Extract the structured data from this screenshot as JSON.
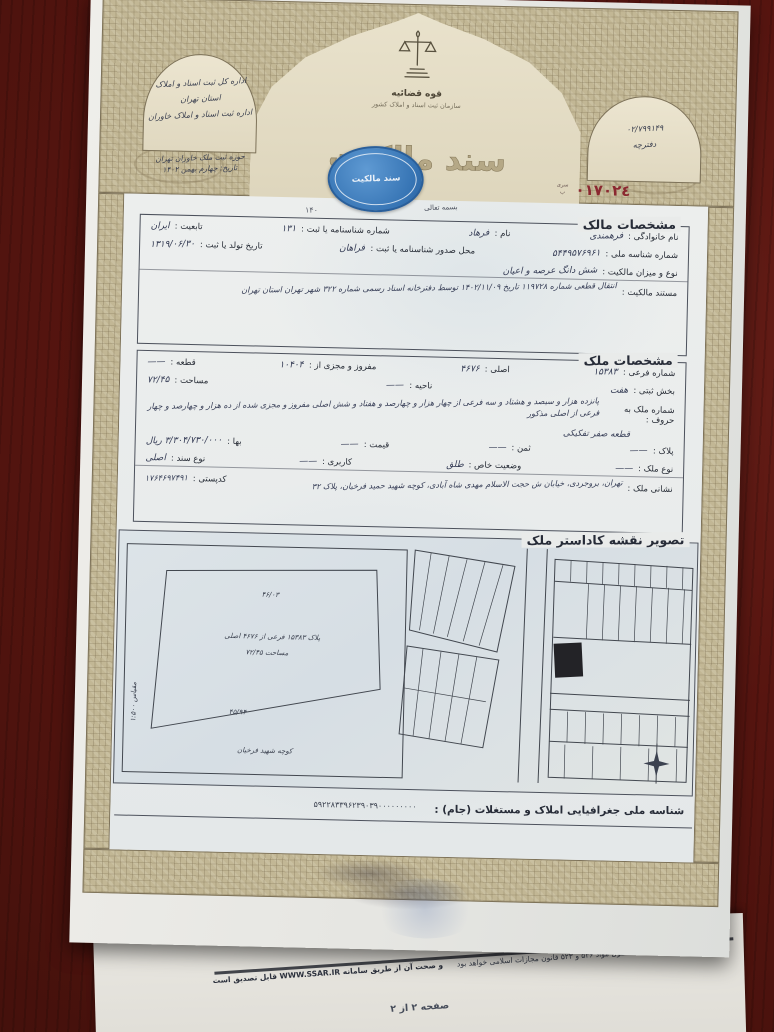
{
  "colors": {
    "seal_blue": "#3674b4",
    "serial_red": "#8b2830",
    "border_tan": "#c2b795",
    "desk_maroon": "#571510"
  },
  "document": {
    "serial": "٠١٧٠٢٤",
    "serial_caption": "سری ب",
    "bismillah": "بسمه تعالی",
    "corner_note": "۱۴۰"
  },
  "header": {
    "judiciary": "قوه قضائیه",
    "org": "سازمان ثبت اسناد و املاک کشور",
    "deed_title": "سند مالکیت",
    "seal_text": "سند مالکیت",
    "left_arch": {
      "line1": "اداره کل ثبت اسناد و املاک",
      "line2": "استان تهران",
      "line3": "اداره ثبت اسناد و املاک خاوران",
      "line4": "حوزه ثبت ملک خاوران تهران",
      "line5": "تاریخ: چهارم بهمن ۱۴۰۲"
    },
    "right_arch": {
      "number": "۰۲/۷۹۹۱۴۹",
      "caption": "دفترچه"
    }
  },
  "owner": {
    "title": "مشخصات مالک",
    "row1": [
      {
        "label": "نام خانوادگی :",
        "value": "فرهمندی"
      },
      {
        "label": "نام :",
        "value": "فرهاد"
      },
      {
        "label": "شماره شناسنامه یا ثبت :",
        "value": "۱۳۱"
      },
      {
        "label": "تابعیت :",
        "value": "ایران"
      }
    ],
    "row2": [
      {
        "label": "شماره شناسه ملی :",
        "value": "۵۴۴۹۵۷۶۹۶۱"
      },
      {
        "label": "محل صدور شناسنامه یا ثبت :",
        "value": "فراهان"
      },
      {
        "label": "تاریخ تولد یا ثبت :",
        "value": "۱۳۱۹/۰۶/۳۰"
      }
    ],
    "row3": {
      "label": "نوع و میزان مالکیت :",
      "value": "شش دانگ عرصه و اعیان"
    },
    "row4": {
      "label": "مستند مالکیت :",
      "value": "انتقال قطعی شماره ۱۱۹۷۲۸ تاریخ ۱۴۰۲/۱۱/۰۹ توسط دفترخانه اسناد رسمی شماره ۳۲۲ شهر تهران استان تهران"
    }
  },
  "property": {
    "title": "مشخصات ملک",
    "row1": [
      {
        "label": "شماره فرعی :",
        "value": "۱۵۳۸۳"
      },
      {
        "label": "اصلی :",
        "value": "۴۶۷۶"
      },
      {
        "label": "مفروز و مجزی از :",
        "value": "۱۰۴۰۴"
      },
      {
        "label": "قطعه :",
        "value": "——"
      }
    ],
    "row2": [
      {
        "label": "بخش ثبتی :",
        "value": "هفت"
      },
      {
        "label": "ناحیه :",
        "value": "——"
      },
      {
        "label": "مساحت :",
        "value": "۷۲/۴۵"
      }
    ],
    "row3": {
      "label": "شماره ملک به حروف :",
      "value": "پانزده هزار و سیصد و هشتاد و سه فرعی از چهار هزار و چهارصد و هفتاد و شش اصلی مفروز و مجزی شده از ده هزار و چهارصد و چهار فرعی از اصلی مذکور"
    },
    "row3b": "قطعه صفر تفکیکی",
    "row4": [
      {
        "label": "پلاک :",
        "value": "——"
      },
      {
        "label": "ثمن :",
        "value": "——"
      },
      {
        "label": "قیمت :",
        "value": "——"
      },
      {
        "label": "بها :",
        "value": "۳/۳۰۴/۷۳۰/۰۰۰ ریال"
      }
    ],
    "row5": [
      {
        "label": "نوع ملک :",
        "value": "——"
      },
      {
        "label": "وضعیت خاص :",
        "value": "طلق"
      },
      {
        "label": "کاربری :",
        "value": "——"
      },
      {
        "label": "نوع سند :",
        "value": "اصلی"
      }
    ],
    "row6": [
      {
        "label": "نشانی ملک :",
        "value": "تهران، بروجردی، خیابان ش حجت الاسلام مهدی شاه آبادی، کوچه شهید حمید فرخیان، پلاک ۳۲"
      },
      {
        "label": "کدپستی :",
        "value": "۱۷۶۴۶۹۷۴۹۱"
      }
    ]
  },
  "map": {
    "title": "تصویر نقشه کاداستر ملک",
    "parcel": {
      "top_dim": "۴۶/۰۳",
      "line1": "پلاک ۱۵۳۸۳ فرعی از ۴۶۷۶ اصلی",
      "line2": "مساحت ۷۲/۴۵",
      "bottom_dim": "۴۵/۹۴",
      "street": "کوچه شهید فرخیان",
      "side_note": "مقیاس ۱:۵۰۰"
    },
    "geo_label": "شناسه ملی جغرافیایی املاک و مستغلات (جام) :",
    "geo_value": "۵۹۲۲۸۳۳۹۶۲۳۹۰۳۹۰۰۰۰۰۰۰۰۰"
  },
  "footer": {
    "legal_a": "هر گونه نقل از اسناد رسمی مشمول مواد ۵۳۶ و ۵۲۳ قانون مجازات اسلامی خواهد بود",
    "legal_b": "و صحت آن از طریق سامانه WWW.SSAR.IR قابل تصدیق است",
    "page": "صفحه ۲ از ۲"
  }
}
